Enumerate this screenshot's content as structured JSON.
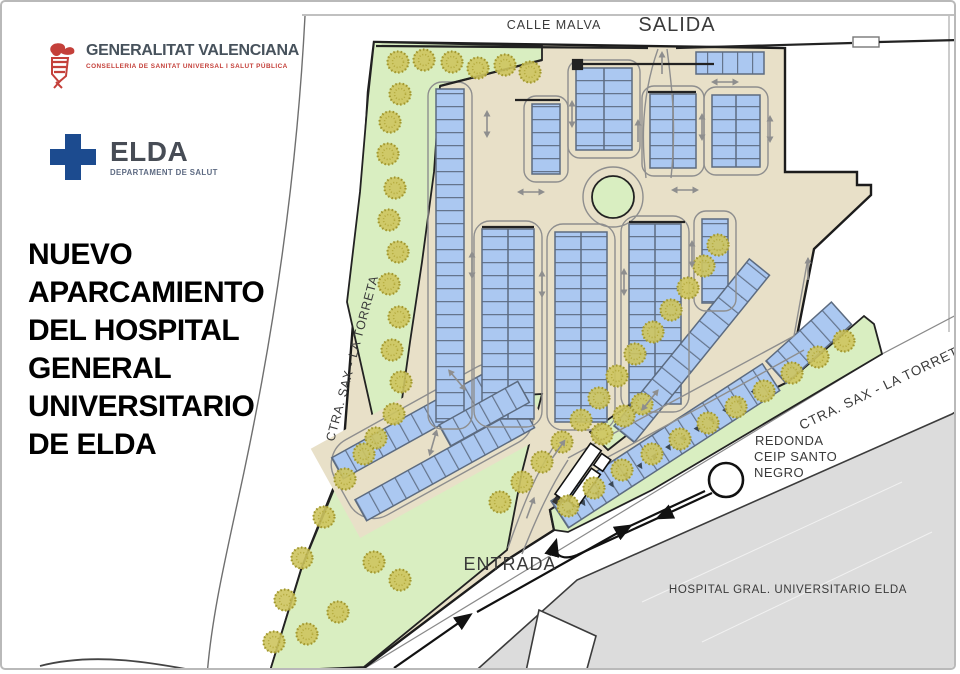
{
  "panel": {
    "gva": {
      "name": "GENERALITAT VALENCIANA",
      "dept": "CONSELLERIA DE SANITAT UNIVERSAL I SALUT PÚBLICA"
    },
    "elda": {
      "name": "ELDA",
      "dept": "DEPARTAMENT DE SALUT"
    },
    "title_lines": [
      "NUEVO",
      "APARCAMIENTO",
      "DEL HOSPITAL",
      "GENERAL",
      "UNIVERSITARIO",
      "DE ELDA"
    ]
  },
  "map": {
    "labels": {
      "street_top": "CALLE MALVA",
      "exit": "SALIDA",
      "entrance": "ENTRADA",
      "road_left": "CTRA. SAX - LA TORRETA",
      "road_right": "CTRA. SAX - LA TORRETA",
      "roundabout_line1": "REDONDA",
      "roundabout_line2": "CEIP SANTO",
      "roundabout_line3": "NEGRO",
      "hospital": "HOSPITAL GRAL. UNIVERSITARIO ELDA"
    },
    "colors": {
      "green_area": "#d9eec1",
      "tree": "#cdc45e",
      "parking_ground": "#e8e0c8",
      "stall_blue": "#abc8f1",
      "stall_border": "#5c6b80",
      "hospital_gray": "#dcdcdc",
      "brand_blue": "#1c4b8f",
      "brand_red": "#c4403a"
    }
  }
}
